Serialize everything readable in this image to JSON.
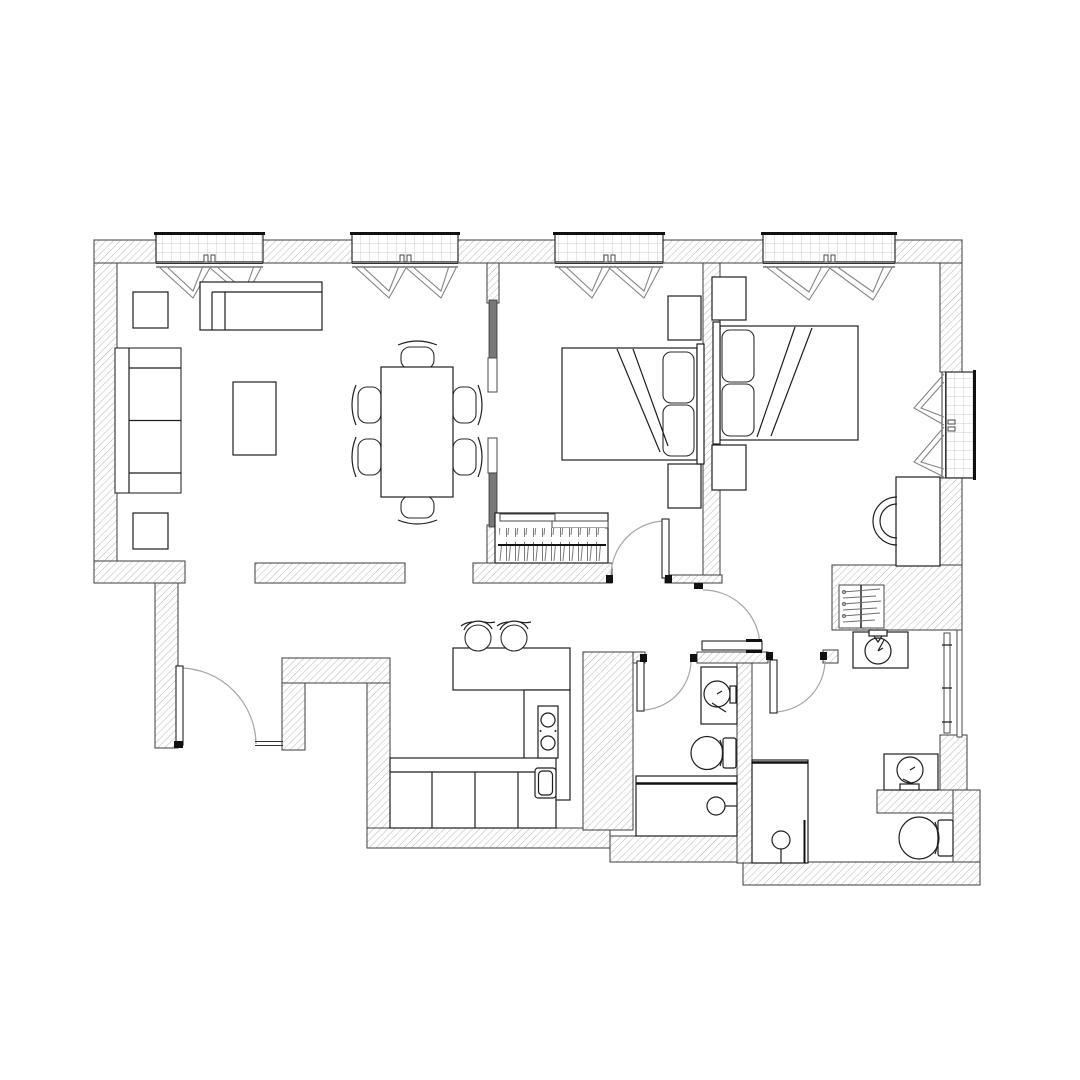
{
  "drawing": {
    "kind": "architectural-floor-plan",
    "style": "black-and-white CAD plan, hatched walls, no text labels",
    "palette": {
      "background": "#ffffff",
      "wall_hatch_line": "#bcbcbc",
      "wall_outline": "#3c3c3c",
      "furniture_line": "#1e1e1e",
      "door_swing_arc": "#a6a6a6",
      "window_grid": "#cccccc",
      "sliding_panel": "#787878"
    },
    "rooms": [
      {
        "id": "living-dining",
        "label": "Living and dining room",
        "furniture": [
          "sofa",
          "side table",
          "side table",
          "coffee table",
          "TV sideboard",
          "dining table",
          "dining chair x6"
        ]
      },
      {
        "id": "kitchen",
        "label": "Kitchen",
        "furniture": [
          "U-shaped counter",
          "cooktop with two burners",
          "kitchen sink",
          "base cabinets",
          "bar stool x2"
        ]
      },
      {
        "id": "bedroom-1",
        "label": "Bedroom 1",
        "furniture": [
          "double bed",
          "pillow x2",
          "nightstand x2",
          "sliding-door wardrobe with hangers"
        ]
      },
      {
        "id": "bedroom-2",
        "label": "Bedroom 2",
        "furniture": [
          "double bed",
          "pillow x2",
          "nightstand x2",
          "desk",
          "desk chair"
        ]
      },
      {
        "id": "bathroom-1",
        "label": "Bathroom 1",
        "furniture": [
          "washbasin vanity",
          "toilet",
          "bathtub"
        ]
      },
      {
        "id": "bathroom-2",
        "label": "Bathroom 2",
        "furniture": [
          "washbasin vanity x2",
          "toilet",
          "walk-in shower",
          "towel radiator",
          "hanger closet"
        ]
      },
      {
        "id": "hallway",
        "label": "Hallway and entry vestibule",
        "furniture": [
          "entrance door",
          "corridor door"
        ]
      }
    ],
    "windows": {
      "count": 5,
      "items": [
        "north window 1",
        "north window 2",
        "north window 3",
        "north window 4",
        "east window"
      ],
      "decor": "double V curtain drapes drawn inside each window"
    },
    "doors": {
      "count": 6,
      "items": [
        "entrance swing door",
        "bedroom-1 swing door",
        "corridor swing door",
        "bathroom-1 swing door",
        "bathroom-2 swing door",
        "sliding partition living/bedroom-1"
      ]
    }
  }
}
